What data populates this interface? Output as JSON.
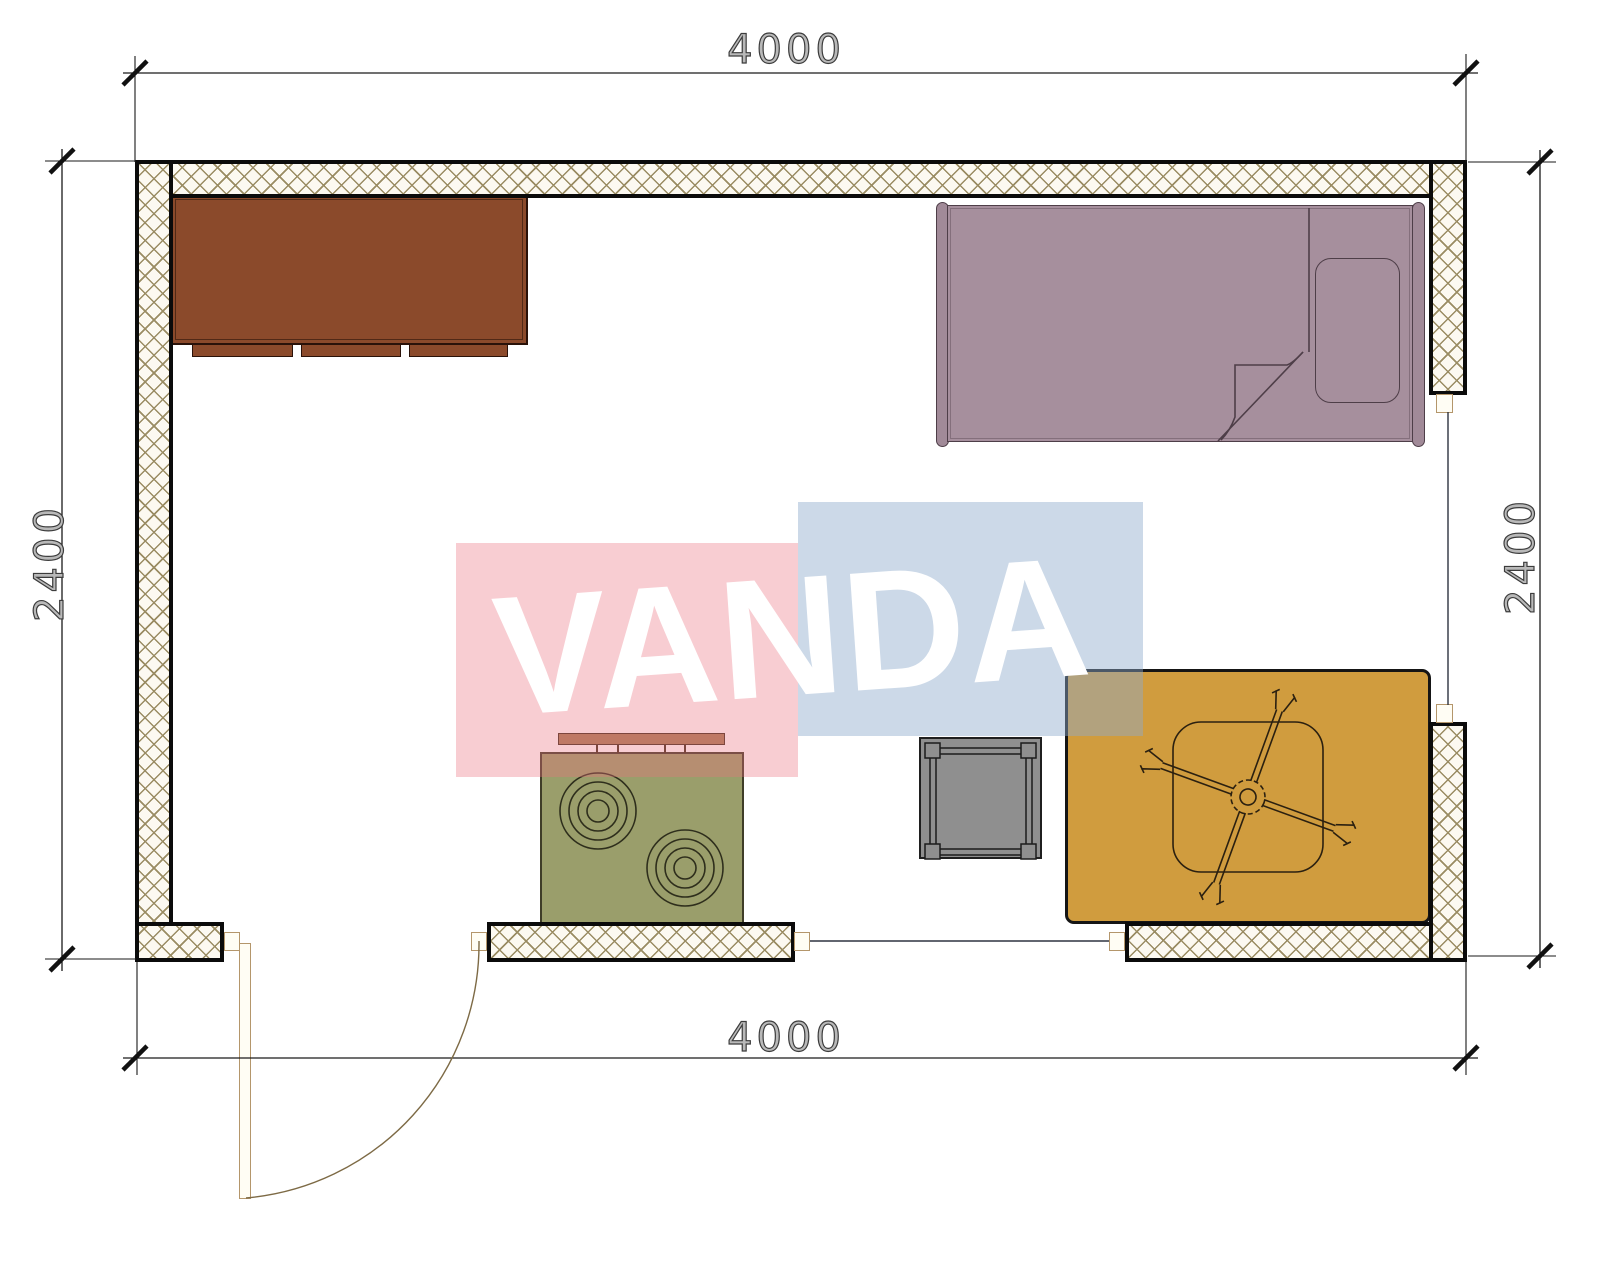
{
  "dimensions": {
    "top": "4000",
    "bottom": "4000",
    "left": "2400",
    "right": "2400"
  },
  "watermark": {
    "text": "VANDA"
  },
  "furniture_symbols": [
    "wardrobe-top-view-icon",
    "single-bed-with-pillow-top-view-icon",
    "stove-two-burners-top-view-icon",
    "square-side-table-top-view-icon",
    "table-with-ceiling-fan-top-view-icon",
    "door-swing-icon",
    "window-icon"
  ],
  "colors": {
    "wall_border": "#0b0b0b",
    "wall_bg": "#fcf9f1",
    "wall_hatch_line": "#9a8c63",
    "cabinet": "#8B4A2B",
    "bed": "#A68F9D",
    "stove": "#9A9E6B",
    "stove_shelf": "#A87E58",
    "side_table": "#8F8F8F",
    "rug_table": "#D09C3E",
    "door": "#FFFDF4",
    "line": "#1a1a1a",
    "wm_red": "rgba(235,112,126,0.35)",
    "wm_blue": "rgba(142,170,204,0.45)",
    "wm_text": "#ffffff"
  }
}
